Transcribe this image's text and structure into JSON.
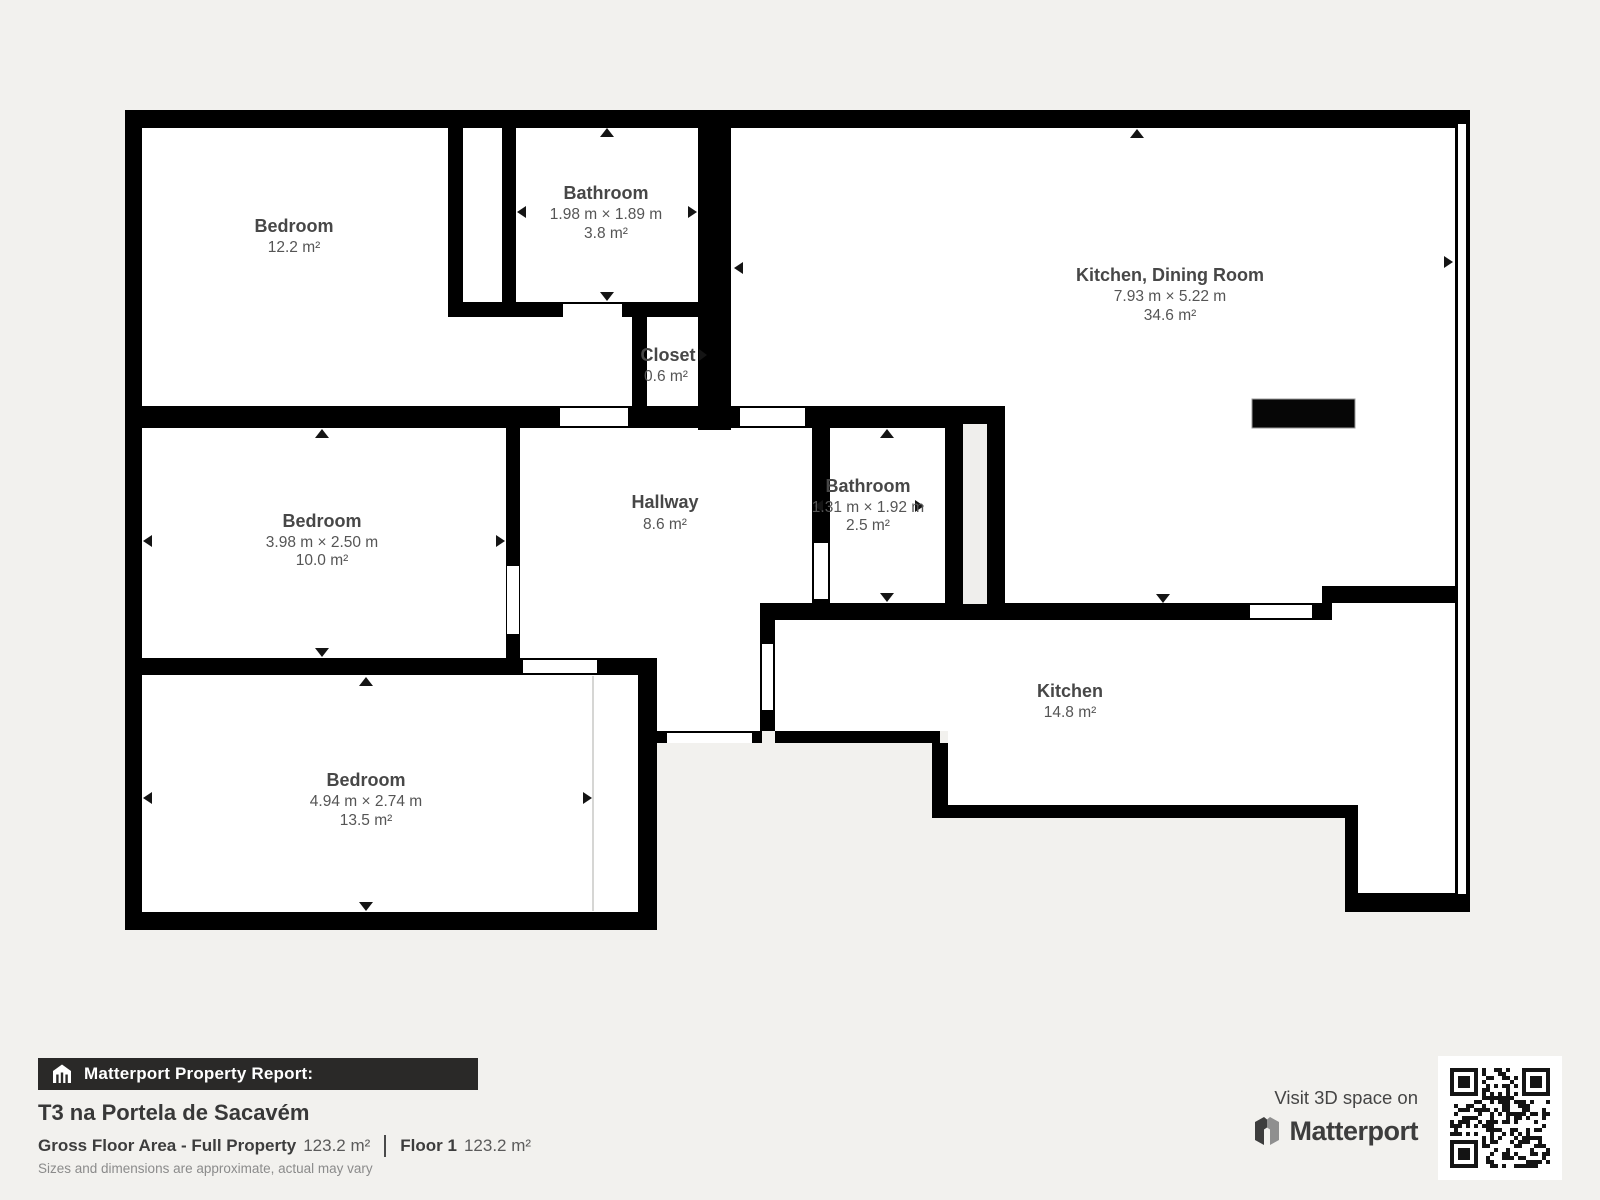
{
  "plan": {
    "rooms": {
      "bedroom_tl": {
        "name": "Bedroom",
        "area": "12.2 m²"
      },
      "bathroom_tl": {
        "name": "Bathroom",
        "dims": "1.98 m × 1.89 m",
        "area": "3.8 m²"
      },
      "closet": {
        "name": "Closet",
        "area": "0.6 m²"
      },
      "kitchen_dining": {
        "name": "Kitchen, Dining Room",
        "dims": "7.93 m × 5.22 m",
        "area": "34.6 m²"
      },
      "bedroom_mid": {
        "name": "Bedroom",
        "dims": "3.98 m × 2.50 m",
        "area": "10.0 m²"
      },
      "hallway": {
        "name": "Hallway",
        "area": "8.6 m²"
      },
      "bathroom_mid": {
        "name": "Bathroom",
        "dims": "1.31 m × 1.92 m",
        "area": "2.5 m²"
      },
      "kitchen": {
        "name": "Kitchen",
        "area": "14.8 m²"
      },
      "bedroom_bottom": {
        "name": "Bedroom",
        "dims": "4.94 m × 2.74 m",
        "area": "13.5 m²"
      }
    },
    "colors": {
      "wall": "#000000",
      "room": "#ffffff",
      "background": "#f2f1ee",
      "label": "#474747"
    }
  },
  "footer": {
    "report_label": "Matterport Property Report:",
    "property_title": "T3 na Portela de Sacavém",
    "gross_label": "Gross Floor Area - Full Property",
    "gross_value": "123.2 m²",
    "floor_label": "Floor 1",
    "floor_value": "123.2 m²",
    "disclaimer": "Sizes and dimensions are approximate, actual may vary",
    "visit_text": "Visit 3D space on",
    "brand": "Matterport"
  }
}
